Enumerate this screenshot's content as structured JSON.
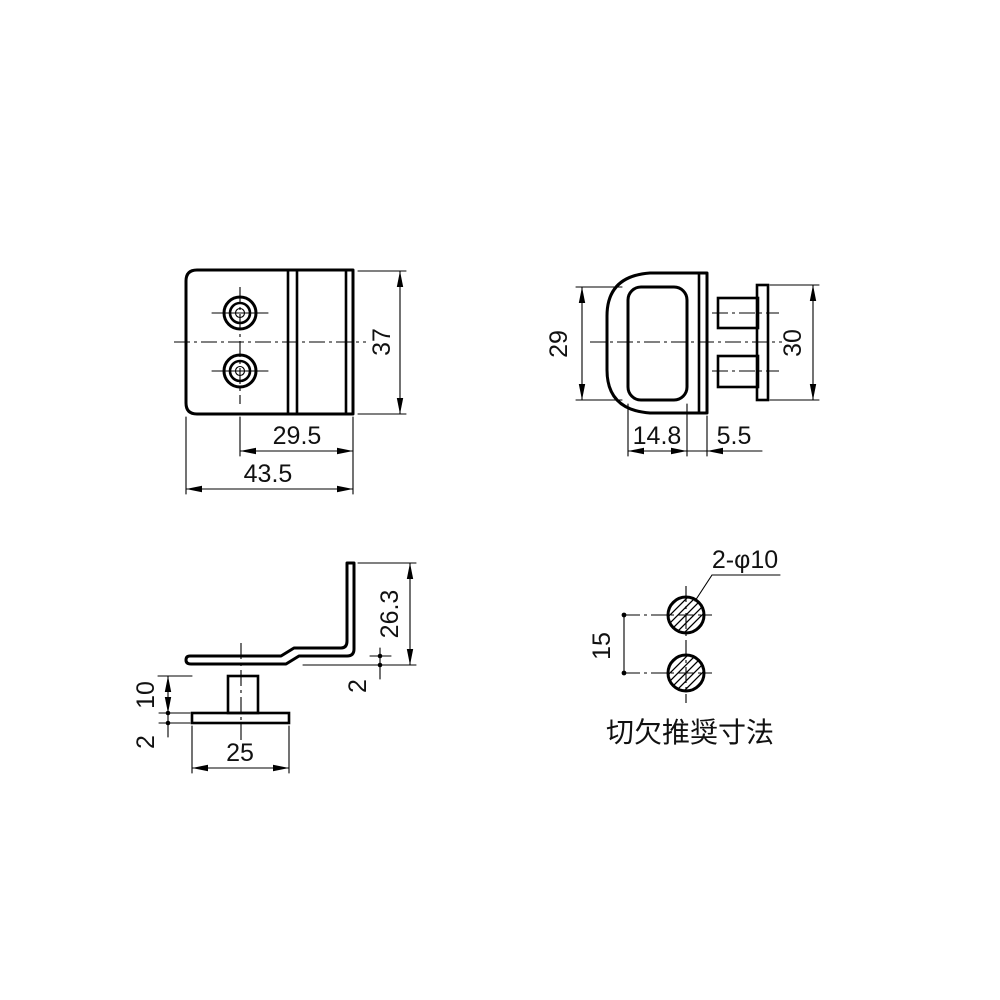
{
  "colors": {
    "line": "#000000",
    "background": "#ffffff"
  },
  "views": {
    "front": {
      "dims": {
        "height": "37",
        "hole_to_edge": "29.5",
        "total_width": "43.5"
      }
    },
    "side": {
      "dims": {
        "opening_height": "29",
        "flange_height": "30",
        "body_depth": "14.8",
        "lip_depth": "5.5"
      }
    },
    "profile": {
      "dims": {
        "leg_height": "26.3",
        "bend_offset": "2",
        "stud_length": "10",
        "flange_thickness": "2",
        "flange_width": "25"
      }
    },
    "cutout": {
      "leader_label": "2-φ10",
      "hole_pitch": "15",
      "caption": "切欠推奨寸法"
    }
  }
}
